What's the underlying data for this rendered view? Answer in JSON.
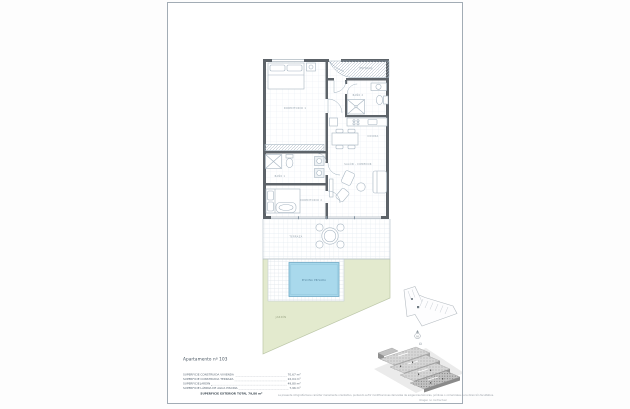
{
  "legend": {
    "title": "Apartamento nº 103",
    "rows": [
      {
        "label": "SUPERFICIE CONSTRUIDA VIVIENDA",
        "value": "70,67 m²"
      },
      {
        "label": "SUPERFICIE CONSTRUIDA TERRAZA",
        "value": "22,04 m²"
      },
      {
        "label": "SUPERFICIE JARDÍN",
        "value": "49,80 m²"
      },
      {
        "label": "SUPERFICIE LÁMINA DE AGUA PISCINA",
        "value": "7,96 m²"
      }
    ],
    "total": "SUPERFICIE EXTERIOR TOTAL 79,80 m²"
  },
  "rooms": {
    "bedroom1": "DORMITORIO 1",
    "bath1": "BAÑO 1",
    "bedroom2": "DORMITORIO 2",
    "entry": "ENTRADA",
    "bath2": "BAÑO 2",
    "kitchen": "COCINA",
    "living": "SALÓN - COMEDOR",
    "terrace": "TERRAZA",
    "pool": "PISCINA PRIVADA",
    "garden": "JARDÍN"
  },
  "north": {
    "label": "N"
  },
  "footnotes": {
    "disclaimer": "La presente infografía tiene carácter meramente orientativo, pudiendo sufrir modificaciones derivadas de exigencias técnicas, jurídicas o comerciales de la dirección facultativa.",
    "note": "Imagen no contractual"
  },
  "colors": {
    "wall": "#5d6369",
    "pool_fill": "#a9d9ec",
    "garden_fill": "#e3eace",
    "grid_line": "#e2e9ef",
    "sheet_border": "#a2acb5"
  }
}
